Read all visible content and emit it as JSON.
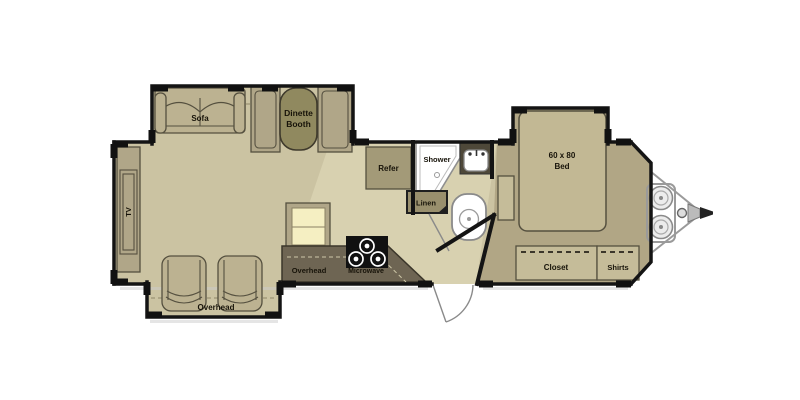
{
  "page": {
    "description": "RV travel trailer floor plan, hitch at front right",
    "background": "#ffffff"
  },
  "labels": {
    "sofa": "Sofa",
    "dinette_line1": "Dinette",
    "dinette_line2": "Booth",
    "tv": "TV",
    "refer": "Refer",
    "shower": "Shower",
    "linen": "Linen",
    "bed_line1": "60 x 80",
    "bed_line2": "Bed",
    "closet": "Closet",
    "shirts": "Shirts",
    "overhead_kitchen": "Overhead",
    "microwave": "Microwave",
    "overhead_chairs": "Overhead"
  },
  "colors": {
    "wall": "#141414",
    "floor_main": "#cbc3a2",
    "floor_corridor": "#d8d1b0",
    "floor_bedroom": "#b1a685",
    "furniture": "#bcb291",
    "bench": "#b0a688",
    "table": "#90895f",
    "counter": "#6e6553",
    "pantry": "#f5efc2",
    "stove": "#111111",
    "cabinet": "#c5bc99",
    "refer_cabinet": "#a39a78",
    "linen_cabinet": "#998f6d",
    "bed": "#c2b894",
    "fixture": "#ffffff"
  }
}
